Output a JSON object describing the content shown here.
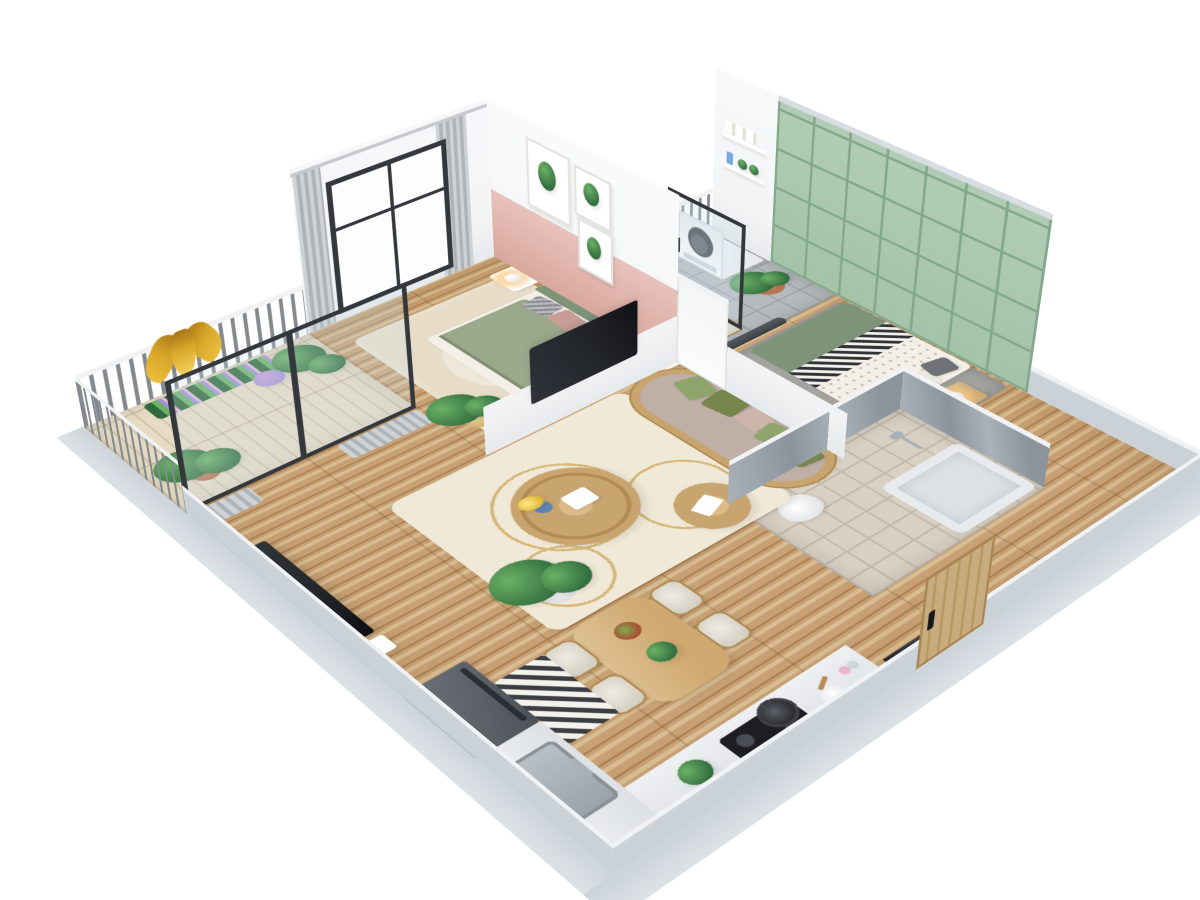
{
  "scene": {
    "title": "3D isometric cutaway floor plan of a one-bedroom-plus apartment",
    "style": "isometric-cutaway-render",
    "emblem": "gold-tulip-ornament-on-balcony-railing"
  },
  "palette": {
    "bg": "#ffffff",
    "wall-white": "#f4f5f6",
    "wall-shade": "#e7eaec",
    "wall-cap": "#d8dde1",
    "plinth": "#ccd3d9",
    "plinth-face": "#dde2e6",
    "wood-mid": "#c7a175",
    "wood-dark": "#ad8251",
    "wood-light": "#d9bd92",
    "balcony-wood": "#e6dcc6",
    "balcony-wood-dark": "#d4c6a8",
    "tile-gray": "#b6babd",
    "tile-gray-line": "#9fa3a7",
    "tile-beige": "#d9d0c4",
    "tile-beige-line": "#c3b9aa",
    "marble-a": "#aab2b9",
    "marble-b": "#8b949c",
    "pink": "#d9a89f",
    "pink-light": "#e8c3bb",
    "green-wall": "#a4c3a9",
    "green-line": "#83a98c",
    "headboard": "#7d9478",
    "duvet": "#9aa88c",
    "duvet-dark": "#828f74",
    "sheet": "#f3efe6",
    "pillow-gray": "#97989d",
    "pillow-pink": "#c79d96",
    "olive": "#77864d",
    "sage": "#8da46c",
    "blush": "#cdb5ac",
    "sofa-seat": "#beb0a6",
    "rattan": "#c8a46e",
    "rattan-dark": "#b08b52",
    "rug-cream": "#f1e9d7",
    "rug-gold": "#d6b87c",
    "rug-gray": "#a3a3a0",
    "frame-dark": "#34383d",
    "glass": "#cfe0ea",
    "curtain-a": "#ced2d5",
    "curtain-b": "#aeb3b7",
    "rail-bar": "#83898e",
    "rail-top": "#f0f2f4",
    "white": "#ffffff",
    "washer-dark": "#41454b",
    "counter": "#eef0f2",
    "counter-face": "#dde1e4",
    "fridge": "#5b6167",
    "steel": "#a9b1b8",
    "cooktop": "#1c1e22",
    "leaf-dark": "#2e6a3b",
    "leaf-light": "#6cb167",
    "terracotta": "#b5704f",
    "gold": "#d9a62a",
    "gold-dark": "#a87414",
    "glow": "#ffc87e",
    "purple": "#9f93d4",
    "tv": "#22252a",
    "door-wood": "#c9ab80",
    "shadow": "#00000018"
  },
  "rooms": [
    {
      "id": "balcony",
      "items": [
        "railing",
        "gold-tulip-emblem",
        "flower-planter-boxes",
        "potted-palm",
        "potted-palm-2",
        "sliding-glass-door"
      ]
    },
    {
      "id": "master-bedroom",
      "items": [
        "window",
        "curtains",
        "double-bed-sage-duvet",
        "green-headboard",
        "pillows",
        "nightstand-left",
        "table-lamp-left",
        "nightstand-right",
        "table-lamp-right",
        "botanical-art-frames",
        "cream-rug",
        "partition-tv"
      ]
    },
    {
      "id": "laundry-balcony",
      "items": [
        "washing-machine",
        "wall-shelves",
        "towels",
        "detergent-bottle",
        "potted-plant",
        "railing-planter",
        "glass-door"
      ]
    },
    {
      "id": "workspace",
      "items": [
        "desk",
        "laptop",
        "books",
        "desk-plant",
        "chair-1",
        "chair-2"
      ]
    },
    {
      "id": "second-bedroom",
      "items": [
        "green-panel-accent-wall",
        "bed-chevron-throw",
        "green-blanket",
        "dotted-duvet",
        "gray-pillows",
        "nightstand",
        "table-lamp",
        "gray-rug",
        "padded-rail"
      ]
    },
    {
      "id": "bathroom",
      "items": [
        "wood-vanity",
        "basin",
        "toilet",
        "bathtub",
        "shower-set",
        "marble-walls",
        "fiddle-leaf-plant",
        "vanity-plant"
      ]
    },
    {
      "id": "living-room",
      "items": [
        "rattan-sofa",
        "green-cushions",
        "coffee-table",
        "flower-vase",
        "gift-box",
        "rattan-pouf",
        "patterned-cream-rug",
        "tv-panel",
        "media-box",
        "fiddle-leaf-plant",
        "curtains"
      ]
    },
    {
      "id": "dining-area",
      "items": [
        "wood-dining-table",
        "chair-1",
        "chair-2",
        "chair-3",
        "chair-4",
        "salad-bowl",
        "herb-plant",
        "monstera-plant"
      ]
    },
    {
      "id": "kitchen",
      "items": [
        "refrigerator",
        "counter-L",
        "double-sink",
        "faucet",
        "chevron-floor-mat",
        "induction-cooktop",
        "cooking-pot",
        "prep-bowl",
        "utensils",
        "spice-bottles",
        "counter-plant",
        "entry-door",
        "dark-marble-threshold"
      ]
    }
  ]
}
